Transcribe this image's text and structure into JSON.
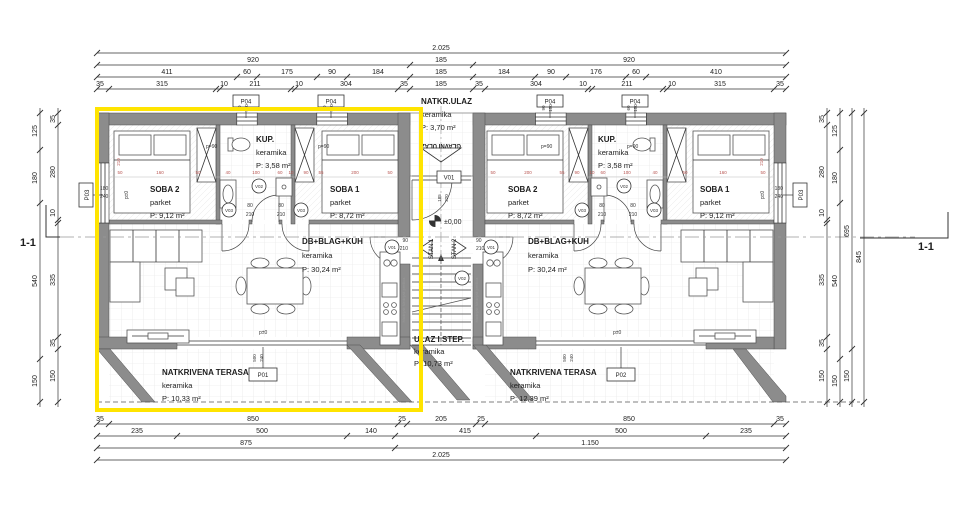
{
  "drawing": {
    "section_label": "1-1",
    "level_label": "±0,00",
    "entry_arrow_label": "GLAVNI ULAZ",
    "unit1_label": "STAN 1",
    "unit2_label": "STAN 2"
  },
  "rooms": {
    "left_soba2": {
      "name": "SOBA 2",
      "floor": "parket",
      "area": "P: 9,12 m²"
    },
    "left_kup": {
      "name": "KUP.",
      "floor": "keramika",
      "area": "P: 3,58 m²"
    },
    "left_soba1": {
      "name": "SOBA 1",
      "floor": "parket",
      "area": "P: 8,72 m²"
    },
    "left_living": {
      "name": "DB+BLAG+KUH",
      "floor": "keramika",
      "area": "P: 30,24 m²"
    },
    "left_terrace": {
      "name": "NATKRIVENA TERASA",
      "floor": "keramika",
      "area": "P: 10,33 m²"
    },
    "entry_porch": {
      "name": "NATKR.ULAZ",
      "floor": "keramika",
      "area": "P: 3,70 m²"
    },
    "hall": {
      "name": "ULAZ I STEP.",
      "floor": "keramika",
      "area": "P: 10,73 m²"
    },
    "right_soba2": {
      "name": "SOBA 2",
      "floor": "parket",
      "area": "P: 8,72 m²"
    },
    "right_kup": {
      "name": "KUP.",
      "floor": "keramika",
      "area": "P: 3,58 m²"
    },
    "right_soba1": {
      "name": "SOBA 1",
      "floor": "parket",
      "area": "P: 9,12 m²"
    },
    "right_living": {
      "name": "DB+BLAG+KUH",
      "floor": "keramika",
      "area": "P: 30,24 m²"
    },
    "right_terrace": {
      "name": "NATKRIVENA TERASA",
      "floor": "keramika",
      "area": "P: 12,39 m²"
    }
  },
  "tags": {
    "p01": "P01",
    "p02": "P02",
    "p03": "P03",
    "p04": "P04",
    "v01": "V01",
    "v02": "V02",
    "v03": "V03",
    "parapet": "p=90",
    "floor_zero": "p±0",
    "kitchen_strip": "hladnjak štednjak perilica"
  },
  "dims": {
    "top": {
      "row1": [
        "2.025"
      ],
      "row2": [
        "920",
        "185",
        "920"
      ],
      "row3": [
        "411",
        "60",
        "175",
        "90",
        "184",
        "185",
        "184",
        "90",
        "176",
        "60",
        "410"
      ],
      "row4": [
        "35",
        "315",
        "10",
        "211",
        "10",
        "304",
        "35",
        "185",
        "35",
        "304",
        "10",
        "211",
        "10",
        "315",
        "35"
      ]
    },
    "bottom": {
      "row1": [
        "35",
        "850",
        "25",
        "205",
        "25",
        "850",
        "35"
      ],
      "row2": [
        "235",
        "500",
        "140",
        "415",
        "500",
        "235"
      ],
      "row3": [
        "875",
        "1.150"
      ],
      "row4": [
        "2.025"
      ]
    },
    "left": {
      "inner": [
        "35",
        "280",
        "10",
        "335",
        "35",
        "150"
      ],
      "outer": [
        "125",
        "180",
        "540",
        "150"
      ]
    },
    "right": {
      "line1": [
        "35",
        "280",
        "10",
        "335",
        "35",
        "150"
      ],
      "line2": [
        "125",
        "180",
        "540",
        "150"
      ],
      "line3": [
        "695",
        "150"
      ],
      "line4": [
        "845"
      ]
    }
  },
  "small_dims": {
    "window_60": [
      "60",
      "150"
    ],
    "window_90": [
      "90",
      "150"
    ],
    "terrace_door": [
      "500",
      "240"
    ],
    "entry_door": [
      "185",
      "220"
    ],
    "side_window": [
      "180",
      "240"
    ],
    "interior_door": [
      "80",
      "210"
    ],
    "unit_door": [
      "90",
      "210"
    ],
    "red_vertical": "210"
  },
  "red_dims": [
    "50",
    "160",
    "50",
    "40",
    "100",
    "60",
    "10",
    "90",
    "55",
    "200",
    "50"
  ],
  "red_dims_right": [
    "50",
    "200",
    "55",
    "90",
    "10",
    "60",
    "100",
    "40",
    "50",
    "160",
    "50"
  ],
  "colors": {
    "highlight": "#ffe400",
    "wall": "#8c8c8c",
    "red_dim": "#b85450"
  }
}
